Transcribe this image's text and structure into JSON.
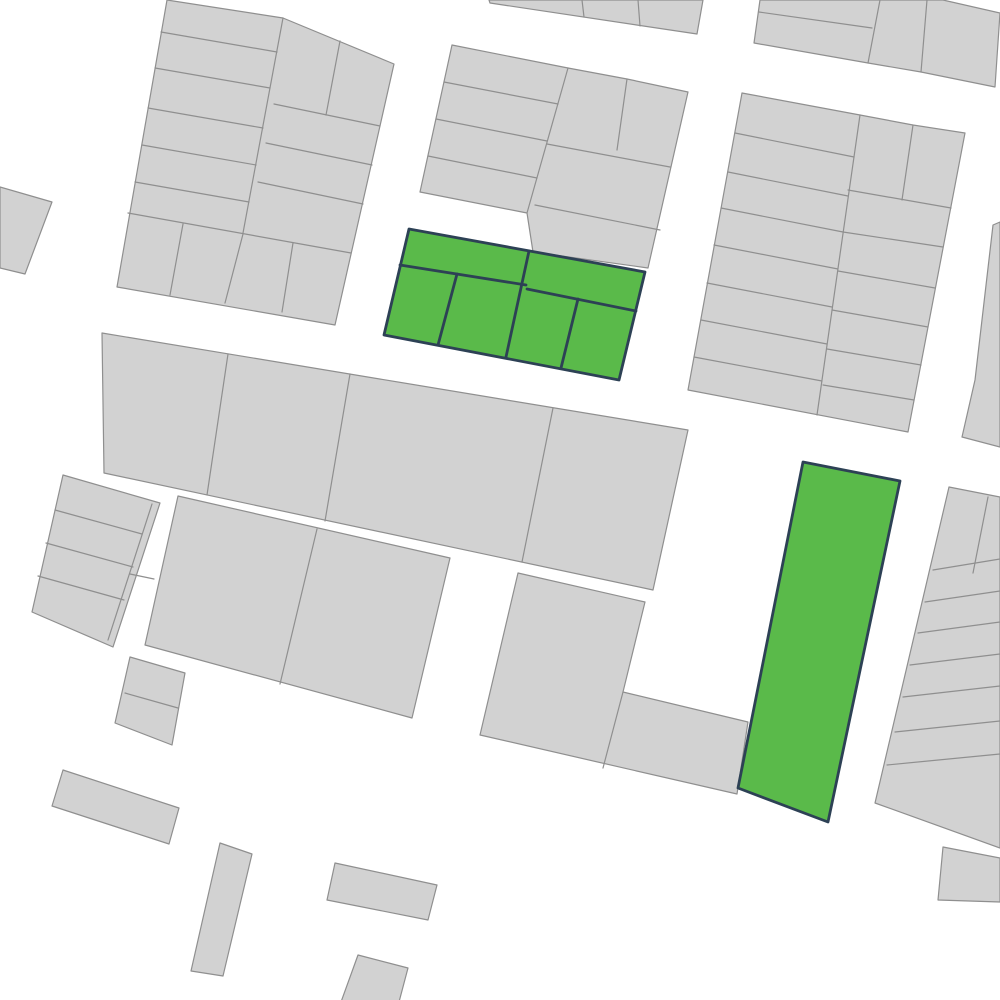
{
  "canvas": {
    "width": 1000,
    "height": 1000
  },
  "palette": {
    "background": "#ffffff",
    "parcel_fill": "#d2d2d2",
    "parcel_stroke": "#8f8f8f",
    "highlight_fill": "#5aba4a",
    "highlight_stroke": "#2d4155"
  },
  "map": {
    "blocks": [
      {
        "name": "block-top-left",
        "color": "gray",
        "outline": [
          [
            167,
            0
          ],
          [
            283,
            18
          ],
          [
            394,
            64
          ],
          [
            335,
            325
          ],
          [
            117,
            287
          ]
        ],
        "dividers": [
          [
            [
              283,
              18
            ],
            [
              243,
              233
            ]
          ],
          [
            [
              161,
              32
            ],
            [
              277,
              52
            ]
          ],
          [
            [
              155,
              68
            ],
            [
              270,
              88
            ]
          ],
          [
            [
              148,
              108
            ],
            [
              263,
              128
            ]
          ],
          [
            [
              142,
              145
            ],
            [
              256,
              165
            ]
          ],
          [
            [
              135,
              182
            ],
            [
              249,
              202
            ]
          ],
          [
            [
              128,
              213
            ],
            [
              351,
              253
            ]
          ],
          [
            [
              340,
              41
            ],
            [
              326,
              115
            ]
          ],
          [
            [
              274,
              104
            ],
            [
              380,
              126
            ]
          ],
          [
            [
              266,
              143
            ],
            [
              372,
              165
            ]
          ],
          [
            [
              258,
              182
            ],
            [
              363,
              204
            ]
          ],
          [
            [
              183,
              224
            ],
            [
              170,
              295
            ]
          ],
          [
            [
              243,
              234
            ],
            [
              225,
              303
            ]
          ],
          [
            [
              293,
              243
            ],
            [
              282,
              312
            ]
          ]
        ]
      },
      {
        "name": "parcel-far-left",
        "color": "gray",
        "outline": [
          [
            0,
            187
          ],
          [
            52,
            202
          ],
          [
            25,
            274
          ],
          [
            0,
            268
          ]
        ],
        "dividers": []
      },
      {
        "name": "strip-top-center",
        "color": "gray",
        "outline": [
          [
            489,
            0
          ],
          [
            703,
            0
          ],
          [
            697,
            34
          ],
          [
            490,
            3
          ]
        ],
        "dividers": [
          [
            [
              582,
              0
            ],
            [
              584,
              17
            ]
          ],
          [
            [
              638,
              0
            ],
            [
              640,
              26
            ]
          ]
        ]
      },
      {
        "name": "block-top-right-upper",
        "color": "gray",
        "outline": [
          [
            760,
            0
          ],
          [
            943,
            0
          ],
          [
            1000,
            13
          ],
          [
            995,
            87
          ],
          [
            921,
            72
          ],
          [
            868,
            63
          ],
          [
            754,
            43
          ]
        ],
        "dividers": [
          [
            [
              759,
              12
            ],
            [
              872,
              28
            ]
          ],
          [
            [
              880,
              0
            ],
            [
              868,
              63
            ]
          ],
          [
            [
              927,
              0
            ],
            [
              921,
              72
            ]
          ]
        ]
      },
      {
        "name": "block-top-center",
        "color": "gray",
        "outline": [
          [
            452,
            45
          ],
          [
            568,
            68
          ],
          [
            627,
            79
          ],
          [
            688,
            92
          ],
          [
            648,
            268
          ],
          [
            533,
            252
          ],
          [
            527,
            213
          ],
          [
            420,
            192
          ]
        ],
        "dividers": [
          [
            [
              568,
              68
            ],
            [
              527,
              213
            ]
          ],
          [
            [
              444,
              82
            ],
            [
              558,
              104
            ]
          ],
          [
            [
              436,
              119
            ],
            [
              547,
              141
            ]
          ],
          [
            [
              428,
              156
            ],
            [
              537,
              178
            ]
          ],
          [
            [
              627,
              79
            ],
            [
              617,
              150
            ]
          ],
          [
            [
              547,
              144
            ],
            [
              670,
              167
            ]
          ],
          [
            [
              535,
              205
            ],
            [
              660,
              230
            ]
          ]
        ]
      },
      {
        "name": "block-top-right",
        "color": "gray",
        "outline": [
          [
            742,
            93
          ],
          [
            860,
            115
          ],
          [
            913,
            125
          ],
          [
            965,
            133
          ],
          [
            908,
            432
          ],
          [
            688,
            390
          ]
        ],
        "dividers": [
          [
            [
              860,
              115
            ],
            [
              817,
              415
            ]
          ],
          [
            [
              735,
              133
            ],
            [
              854,
              157
            ]
          ],
          [
            [
              728,
              172
            ],
            [
              848,
              196
            ]
          ],
          [
            [
              721,
              208
            ],
            [
              843,
              232
            ]
          ],
          [
            [
              714,
              245
            ],
            [
              838,
              269
            ]
          ],
          [
            [
              707,
              283
            ],
            [
              832,
              307
            ]
          ],
          [
            [
              701,
              320
            ],
            [
              827,
              344
            ]
          ],
          [
            [
              694,
              357
            ],
            [
              822,
              381
            ]
          ],
          [
            [
              913,
              125
            ],
            [
              902,
              200
            ]
          ],
          [
            [
              848,
              190
            ],
            [
              951,
              208
            ]
          ],
          [
            [
              843,
              232
            ],
            [
              943,
              247
            ]
          ],
          [
            [
              838,
              271
            ],
            [
              935,
              288
            ]
          ],
          [
            [
              832,
              310
            ],
            [
              928,
              327
            ]
          ],
          [
            [
              827,
              349
            ],
            [
              921,
              365
            ]
          ],
          [
            [
              823,
              385
            ],
            [
              914,
              400
            ]
          ]
        ]
      },
      {
        "name": "sliver-right-edge",
        "color": "gray",
        "outline": [
          [
            993,
            225
          ],
          [
            1000,
            222
          ],
          [
            1000,
            447
          ],
          [
            962,
            437
          ],
          [
            975,
            380
          ]
        ],
        "dividers": []
      },
      {
        "name": "block-mid-left",
        "color": "gray",
        "outline": [
          [
            102,
            333
          ],
          [
            688,
            430
          ],
          [
            653,
            590
          ],
          [
            104,
            473
          ]
        ],
        "dividers": [
          [
            [
              228,
              354
            ],
            [
              207,
              495
            ]
          ],
          [
            [
              350,
              374
            ],
            [
              325,
              521
            ]
          ],
          [
            [
              553,
              408
            ],
            [
              522,
              562
            ]
          ]
        ]
      },
      {
        "name": "block-left-strips",
        "color": "gray",
        "outline": [
          [
            63,
            475
          ],
          [
            160,
            503
          ],
          [
            113,
            647
          ],
          [
            32,
            612
          ]
        ],
        "dividers": [
          [
            [
              55,
              510
            ],
            [
              142,
              534
            ]
          ],
          [
            [
              46,
              543
            ],
            [
              133,
              567
            ]
          ],
          [
            [
              38,
              576
            ],
            [
              124,
              600
            ]
          ],
          [
            [
              152,
              504
            ],
            [
              108,
              640
            ]
          ],
          [
            [
              130,
              574
            ],
            [
              154,
              579
            ]
          ]
        ]
      },
      {
        "name": "parcel-left-small",
        "color": "gray",
        "outline": [
          [
            130,
            657
          ],
          [
            185,
            673
          ],
          [
            172,
            745
          ],
          [
            115,
            723
          ]
        ],
        "dividers": [
          [
            [
              125,
              693
            ],
            [
              178,
              708
            ]
          ]
        ]
      },
      {
        "name": "block-center",
        "color": "gray",
        "outline": [
          [
            178,
            496
          ],
          [
            450,
            558
          ],
          [
            412,
            718
          ],
          [
            145,
            645
          ]
        ],
        "dividers": [
          [
            [
              317,
              529
            ],
            [
              280,
              684
            ]
          ]
        ]
      },
      {
        "name": "block-center-bottom-l",
        "color": "gray",
        "outline": [
          [
            518,
            573
          ],
          [
            645,
            602
          ],
          [
            623,
            692
          ],
          [
            748,
            722
          ],
          [
            737,
            794
          ],
          [
            480,
            735
          ]
        ],
        "dividers": [
          [
            [
              623,
              692
            ],
            [
              603,
              768
            ]
          ]
        ]
      },
      {
        "name": "block-right-column",
        "color": "gray",
        "outline": [
          [
            949,
            487
          ],
          [
            1000,
            497
          ],
          [
            1000,
            848
          ],
          [
            875,
            803
          ]
        ],
        "dividers": [
          [
            [
              933,
              570
            ],
            [
              1000,
              559
            ]
          ],
          [
            [
              925,
              602
            ],
            [
              1000,
              591
            ]
          ],
          [
            [
              918,
              633
            ],
            [
              1000,
              622
            ]
          ],
          [
            [
              910,
              665
            ],
            [
              1000,
              654
            ]
          ],
          [
            [
              903,
              697
            ],
            [
              1000,
              686
            ]
          ],
          [
            [
              895,
              732
            ],
            [
              1000,
              721
            ]
          ],
          [
            [
              887,
              765
            ],
            [
              1000,
              754
            ]
          ],
          [
            [
              988,
              497
            ],
            [
              973,
              573
            ]
          ]
        ]
      },
      {
        "name": "parcel-bottom-right",
        "color": "gray",
        "outline": [
          [
            943,
            847
          ],
          [
            1000,
            858
          ],
          [
            1000,
            902
          ],
          [
            938,
            900
          ]
        ],
        "dividers": []
      },
      {
        "name": "parcel-bar-southwest",
        "color": "gray",
        "outline": [
          [
            63,
            770
          ],
          [
            179,
            808
          ],
          [
            169,
            844
          ],
          [
            52,
            806
          ]
        ],
        "dividers": []
      },
      {
        "name": "parcel-bar-south-vertical",
        "color": "gray",
        "outline": [
          [
            220,
            843
          ],
          [
            252,
            854
          ],
          [
            223,
            976
          ],
          [
            191,
            971
          ]
        ],
        "dividers": []
      },
      {
        "name": "parcel-bar-south-center",
        "color": "gray",
        "outline": [
          [
            335,
            863
          ],
          [
            437,
            885
          ],
          [
            428,
            920
          ],
          [
            327,
            900
          ]
        ],
        "dividers": []
      },
      {
        "name": "parcel-bottom-center",
        "color": "gray",
        "outline": [
          [
            358,
            955
          ],
          [
            408,
            968
          ],
          [
            399,
            1002
          ],
          [
            341,
            1002
          ]
        ],
        "dividers": []
      },
      {
        "name": "selected-block-center",
        "color": "green",
        "outline": [
          [
            409,
            229
          ],
          [
            645,
            272
          ],
          [
            619,
            380
          ],
          [
            384,
            335
          ]
        ],
        "dividers": [
          [
            [
              400,
              265
            ],
            [
              526,
              285
            ]
          ],
          [
            [
              527,
              289
            ],
            [
              636,
              311
            ]
          ],
          [
            [
              529,
              251
            ],
            [
              506,
              357
            ]
          ],
          [
            [
              457,
              274
            ],
            [
              438,
              345
            ]
          ],
          [
            [
              578,
              299
            ],
            [
              561,
              368
            ]
          ]
        ]
      },
      {
        "name": "selected-parcel-tall",
        "color": "green",
        "outline": [
          [
            803,
            462
          ],
          [
            900,
            481
          ],
          [
            828,
            822
          ],
          [
            738,
            788
          ]
        ],
        "dividers": []
      }
    ]
  }
}
